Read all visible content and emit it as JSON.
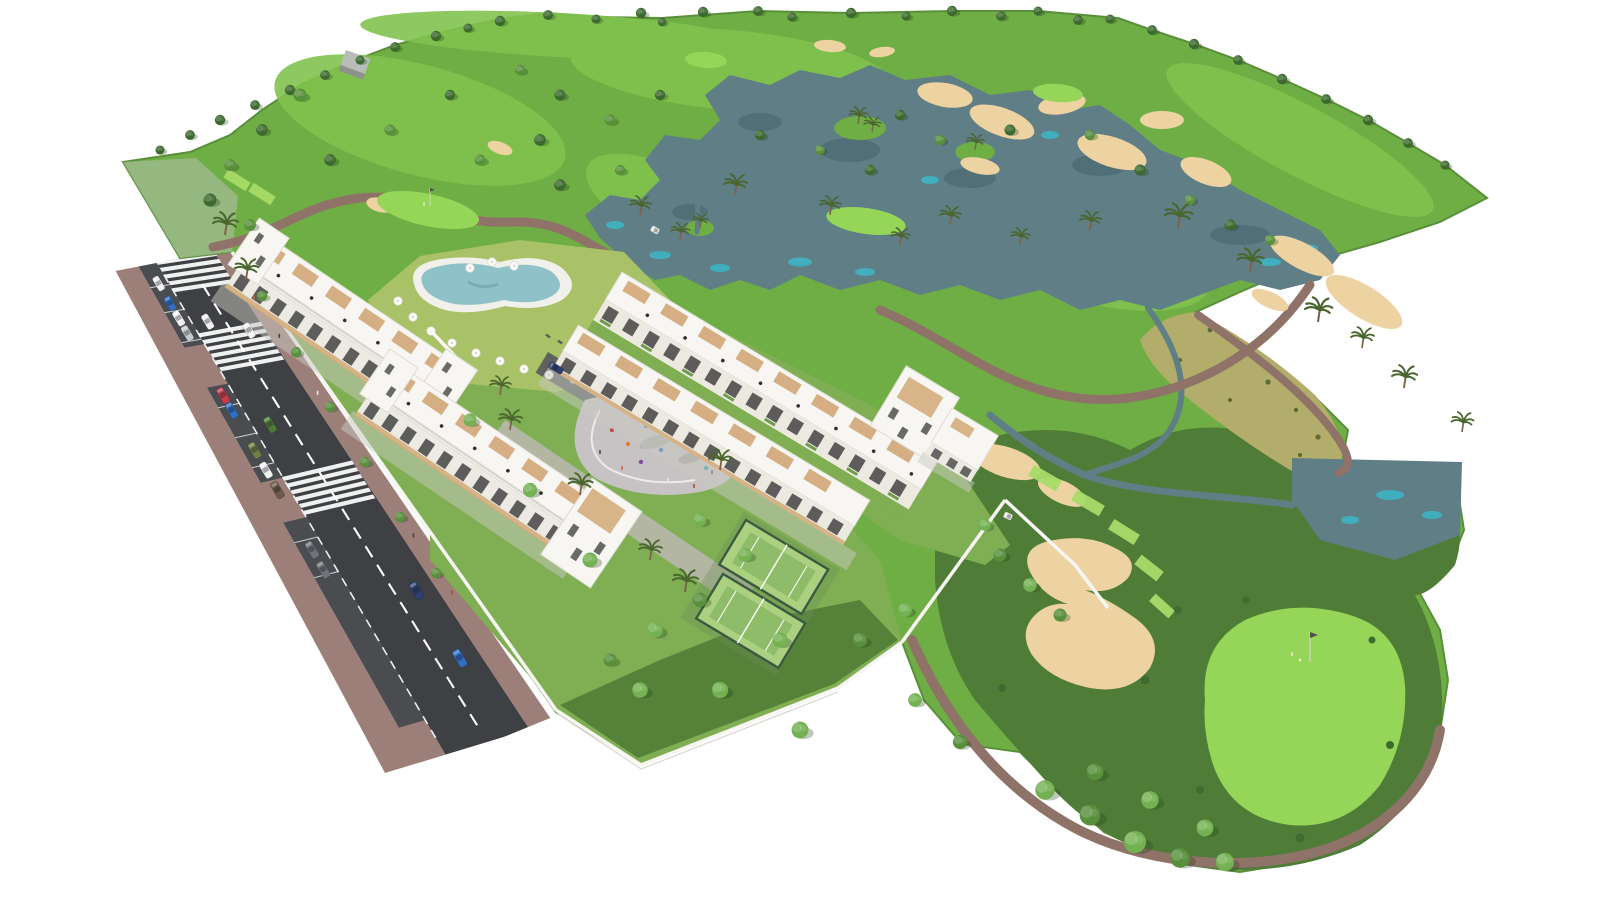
{
  "scene": {
    "type": "3d-aerial-architectural-rendering",
    "subject": "white-apartment-complex-beside-golf-course",
    "background": "#ffffff",
    "features": [
      "golf-course",
      "lakes",
      "streams",
      "sand-bunkers",
      "fairways",
      "putting-greens",
      "tee-boxes",
      "cart-paths",
      "palm-trees",
      "apartment-buildings",
      "rooftop-terraces",
      "swimming-pool",
      "sun-umbrellas",
      "loungers",
      "playground-plaza",
      "padel-courts",
      "garden-walls",
      "access-road",
      "parking-bays",
      "crosswalks",
      "cars",
      "pedestrians",
      "golf-flag",
      "golf-carts",
      "maintenance-shed"
    ]
  },
  "palette": {
    "bg": "#ffffff",
    "courseBase": "#6fae45",
    "courseTipPale": "#9cb98b",
    "fairway": "#82c24e",
    "green": "#95d659",
    "tee": "#a8dc69",
    "rough": "#4f7d38",
    "lushGarden": "#558139",
    "gardenGreen": "#7fae53",
    "lawnYellow": "#a9c167",
    "scrub": "#b3ad6c",
    "sand": "#edd2a2",
    "water": "#5f7e86",
    "waterHi": "#3cb7c7",
    "waterDk": "#3d5a62",
    "path": "#8f7268",
    "sidewalk": "#9c7f78",
    "asphalt": "#3e4043",
    "roadLine": "#ffffff",
    "white": "#f7f6f2",
    "wallShadow": "#d8d6cd",
    "wood": "#d2a877",
    "windowDark": "#3a3a3a",
    "plaza": "#c7c2c4",
    "plazaLight": "#d8d4d5",
    "courtSurface": "#abd080",
    "courtDark": "#8fbc68",
    "fence": "#3b5a40",
    "poolWater": "#8fc2c8",
    "poolDeck": "#f1f0ea",
    "treeDark": "#3c6a2e",
    "treeMid": "#578f3b",
    "treeLight": "#74b152",
    "palmGreen": "#4a662e",
    "trunk": "#7d6247",
    "carWhite": "#f2f2f2",
    "carSilver": "#c7cbcf",
    "carRed": "#c63c4d",
    "carBlue": "#2f6fc0",
    "carNavy": "#2d3f6e",
    "carGreen": "#4e7a38",
    "carOlive": "#6f7f44",
    "carBrown": "#6d594a",
    "carGray": "#70747a"
  },
  "road": {
    "lane_marking_style": "dashed-white",
    "crosswalk_count": 3,
    "parking_bays": true,
    "parked_car_colors": [
      "white",
      "blue",
      "white",
      "silver",
      "red",
      "blue",
      "olive",
      "white",
      "brown",
      "gray",
      "gray"
    ],
    "moving_car_colors": [
      "white",
      "white",
      "green",
      "navy",
      "blue"
    ]
  },
  "counts": {
    "apartment_buildings": 3,
    "end_towers": 3,
    "padel_courts": 2,
    "crosswalks": 3,
    "parked_cars": 11,
    "moving_cars": 5,
    "sun_umbrellas": 15,
    "golf_flags": 2,
    "golf_carts": 2,
    "lakes": 2,
    "tee_boxes": 7
  }
}
